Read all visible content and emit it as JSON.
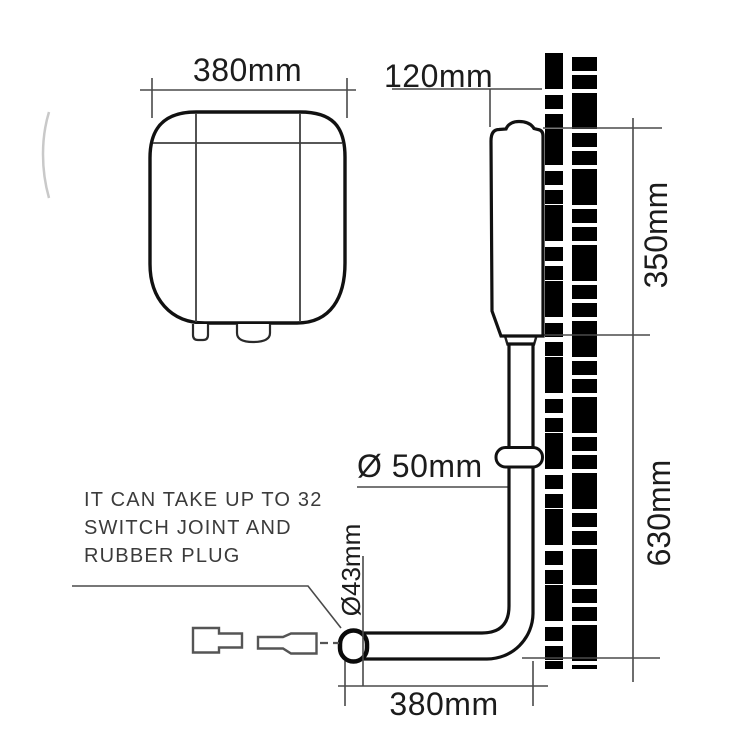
{
  "diagram": {
    "dimensions": {
      "tank_width_top": "380mm",
      "tank_depth": "120mm",
      "tank_height": "350mm",
      "install_height": "630mm",
      "pipe_diameter": "Ø 50mm",
      "outlet_diameter": "Ø43mm",
      "pipe_length_bottom": "380mm"
    },
    "note": {
      "line1": "IT CAN TAKE UP TO 32",
      "line2": "SWITCH JOINT AND",
      "line3": "RUBBER PLUG"
    },
    "colors": {
      "outline": "#111111",
      "dimension_line": "#4a4a4a",
      "wall_hatch": "#000000",
      "label_text": "#1c1c1c",
      "note_text": "#3b3b3b",
      "background": "#ffffff"
    }
  }
}
